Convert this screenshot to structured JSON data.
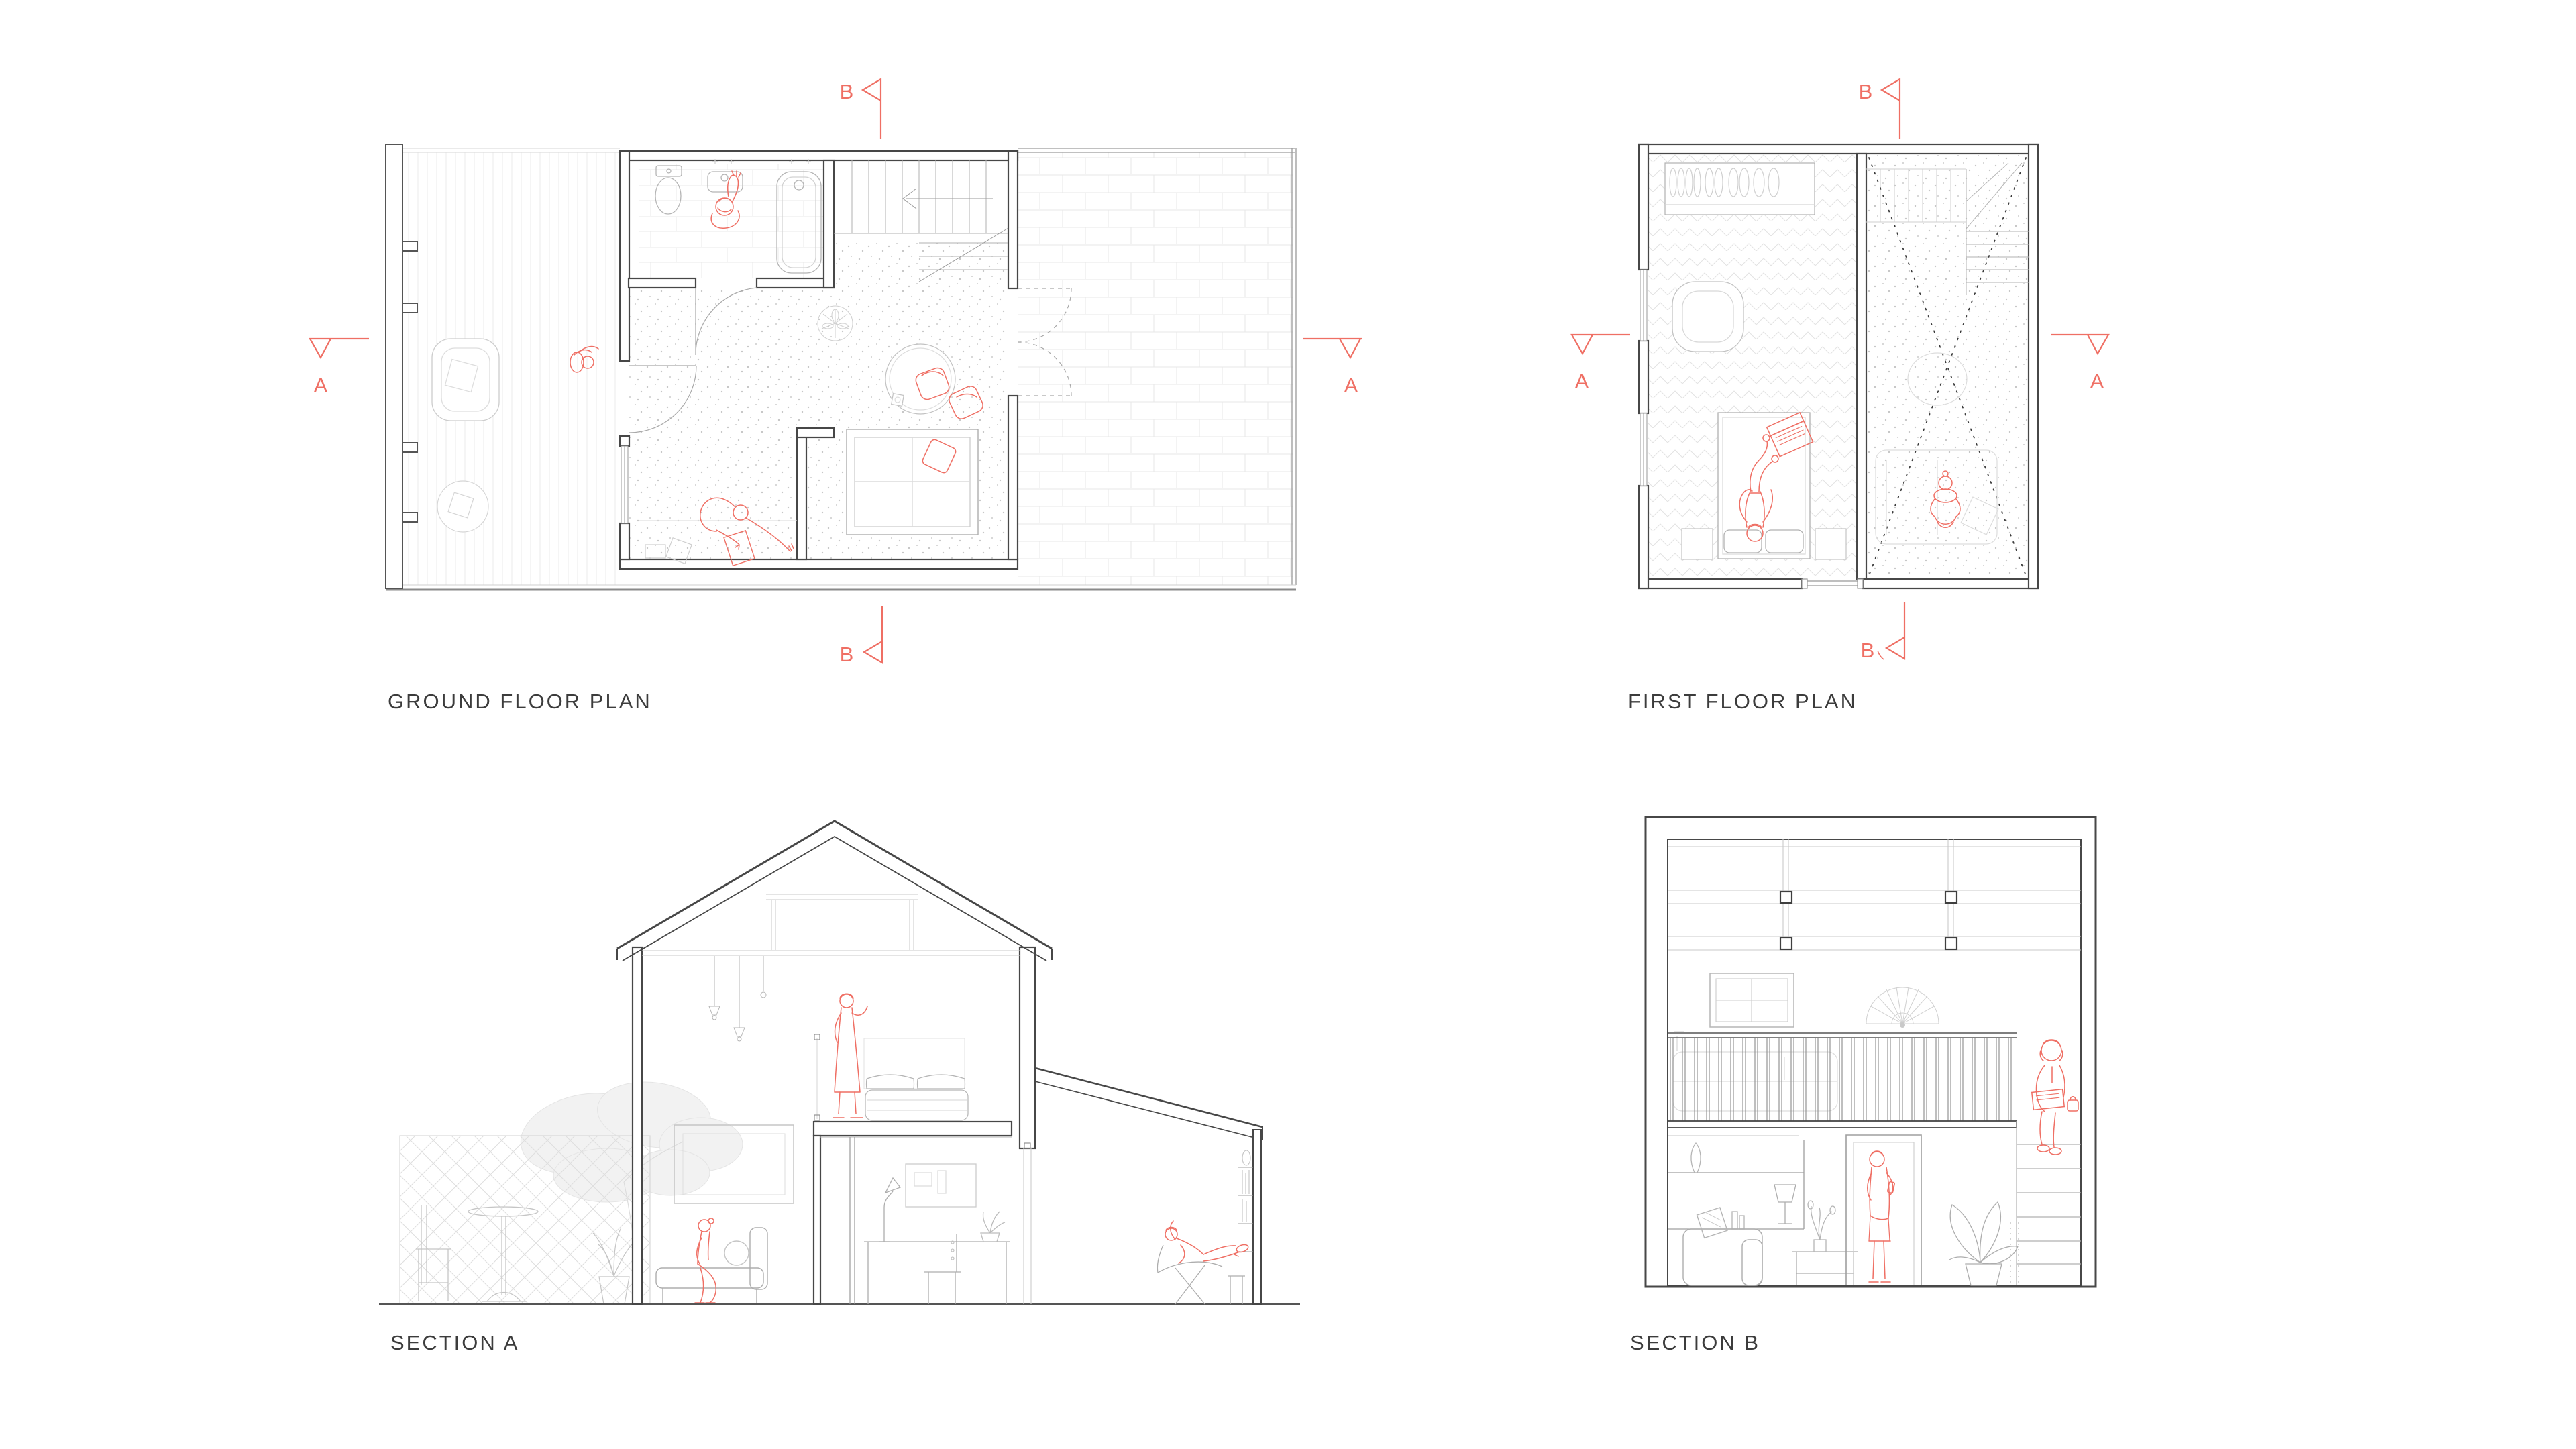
{
  "sheet": {
    "background": "#ffffff"
  },
  "palette": {
    "accent_red": "#ef6f64",
    "wall_dark": "#474747",
    "line_mid": "#a8a8a8",
    "line_light": "#cccccc",
    "hatch_light": "#e6e6e6",
    "label_text": "#3c3c3c"
  },
  "drawings": {
    "ground_floor_plan": {
      "label": "GROUND FLOOR PLAN",
      "markers": {
        "left": "A",
        "right": "A",
        "top": "B",
        "bottom": "B"
      }
    },
    "first_floor_plan": {
      "label": "FIRST FLOOR PLAN",
      "markers": {
        "left": "A",
        "right": "A",
        "top": "B",
        "bottom": "B"
      }
    },
    "section_a": {
      "label": "SECTION A"
    },
    "section_b": {
      "label": "SECTION B"
    }
  }
}
